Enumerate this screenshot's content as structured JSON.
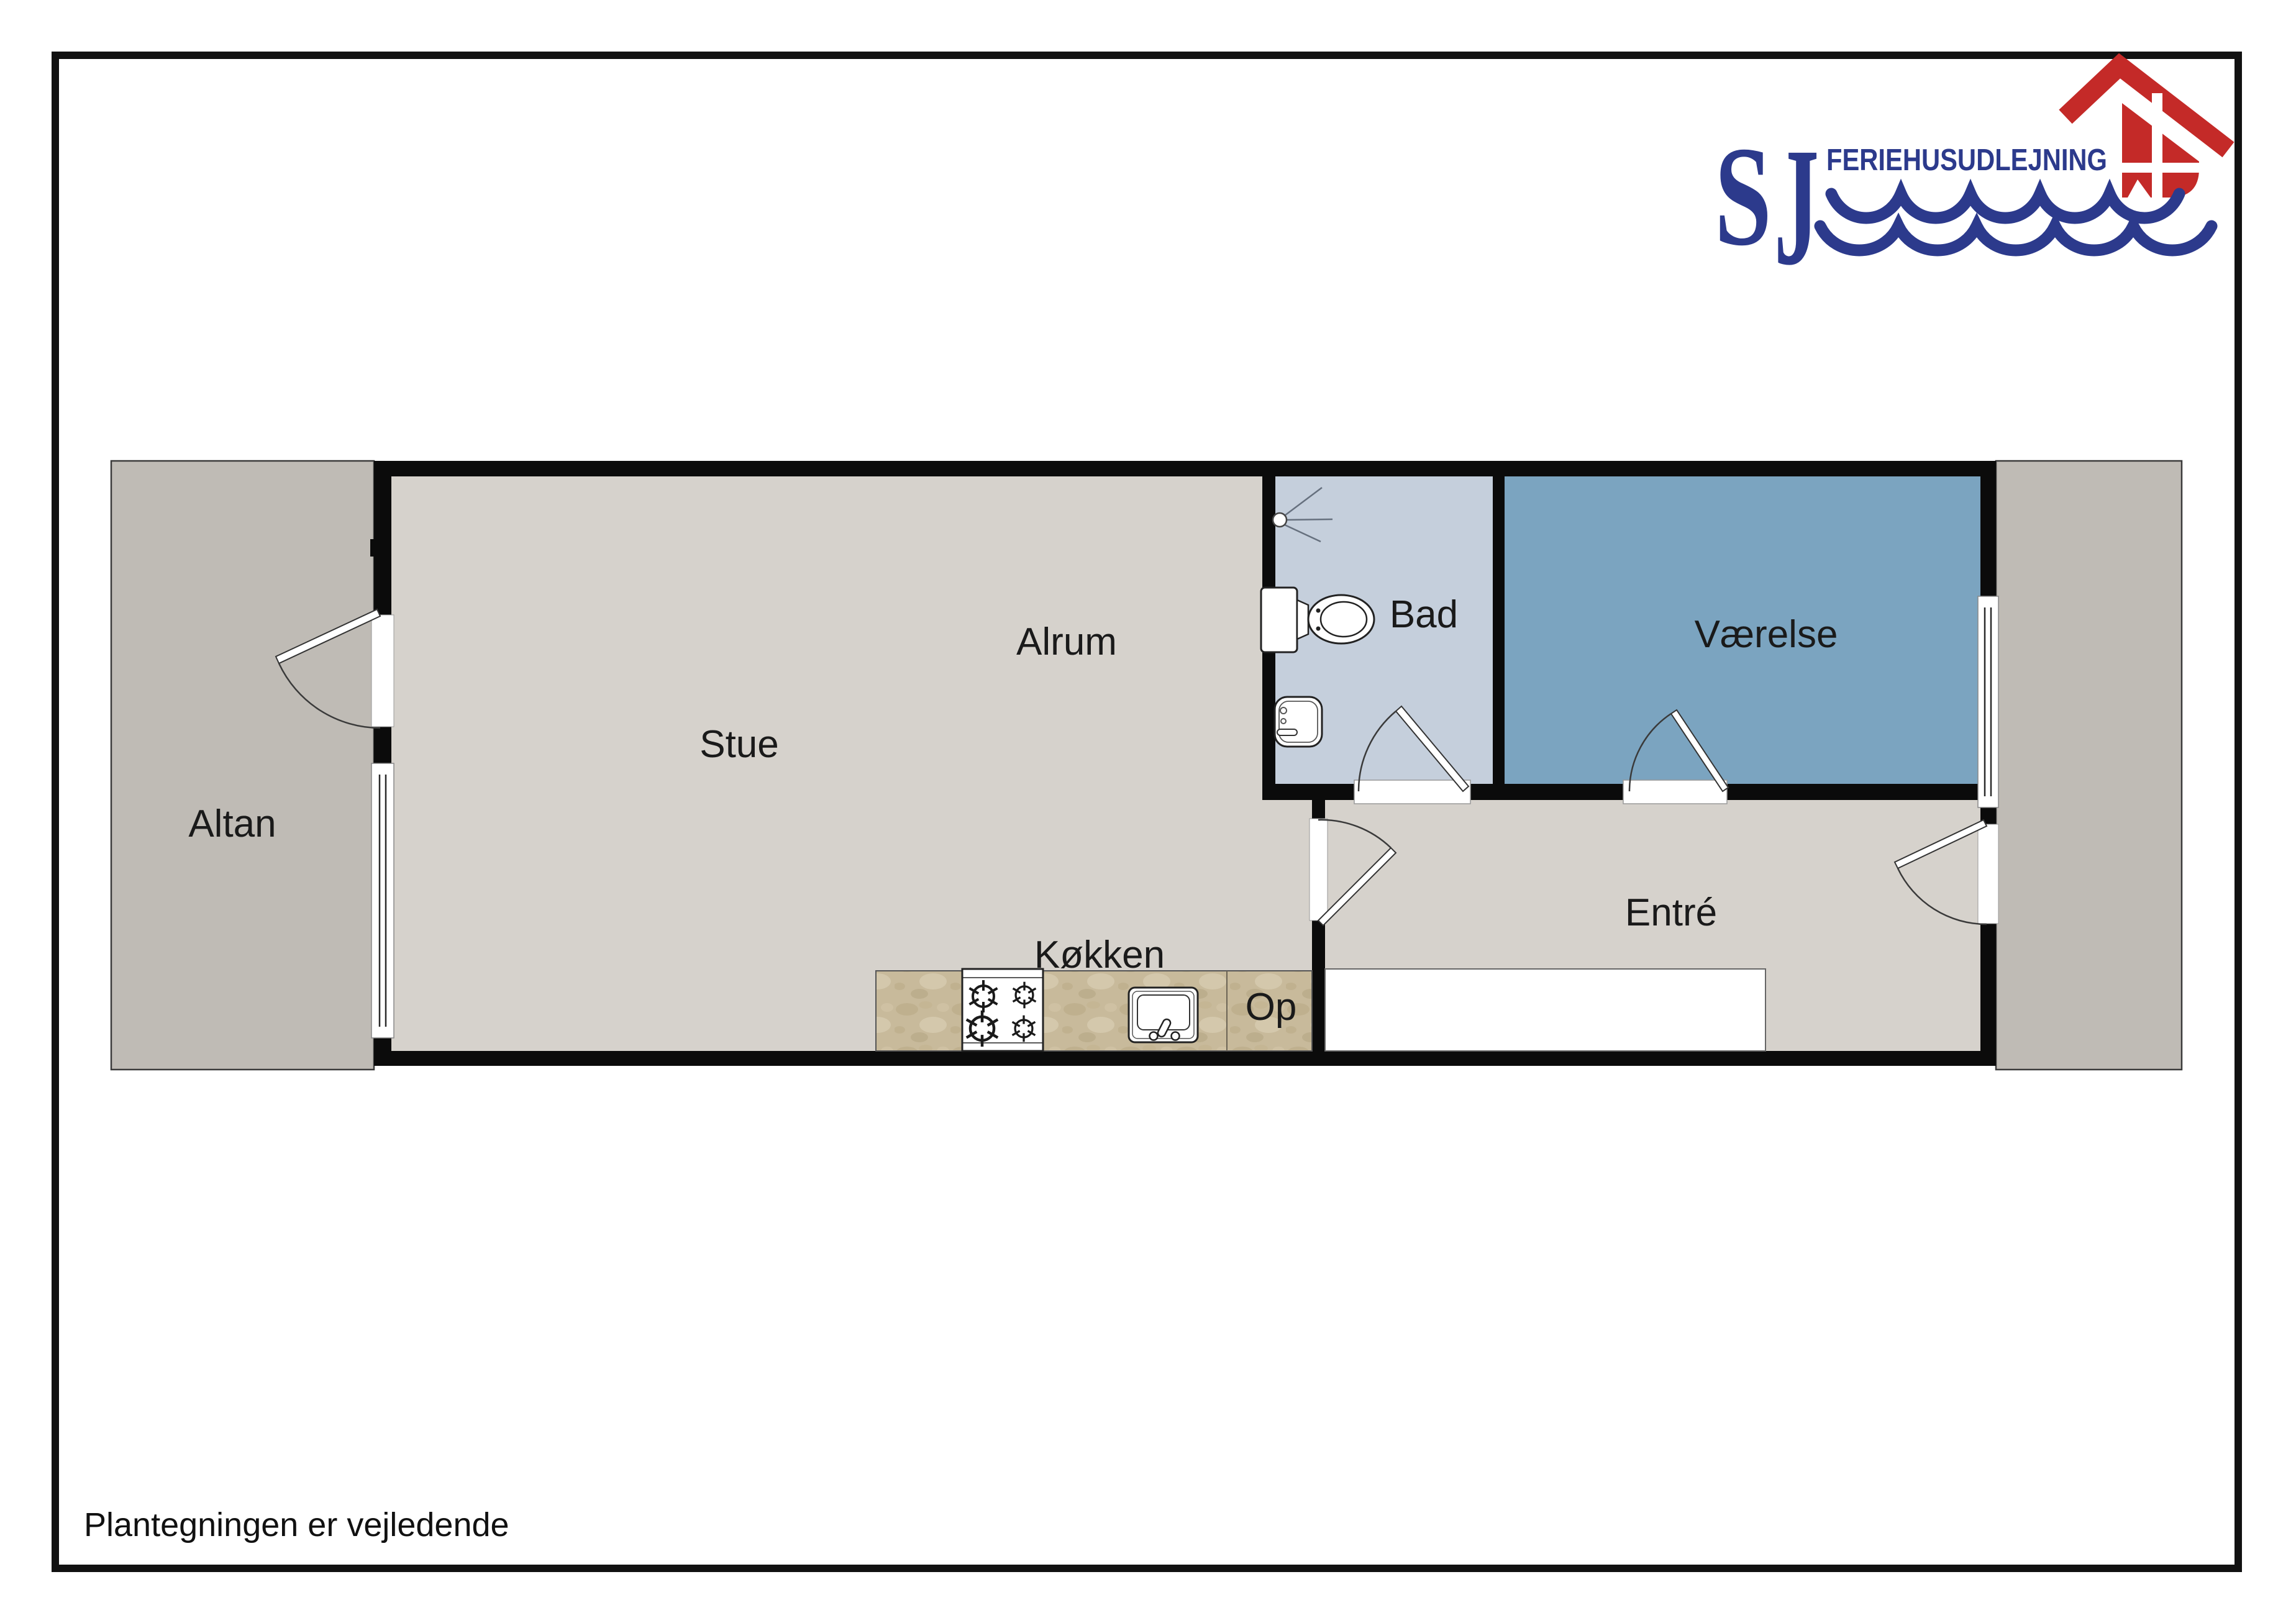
{
  "page": {
    "footnote": "Plantegningen er vejledende",
    "frame_color": "#111111",
    "background": "#ffffff"
  },
  "logo": {
    "monogram_s": "S",
    "monogram_j": "J",
    "wordmark": "FERIEHUSUDLEJNING",
    "colors": {
      "navy": "#2C3A8C",
      "red": "#C42A28"
    }
  },
  "floorplan": {
    "rooms": [
      {
        "id": "altan",
        "label": "Altan"
      },
      {
        "id": "stue",
        "label": "Stue"
      },
      {
        "id": "alrum",
        "label": "Alrum"
      },
      {
        "id": "koekken",
        "label": "Køkken"
      },
      {
        "id": "bad",
        "label": "Bad"
      },
      {
        "id": "vaerelse",
        "label": "Værelse"
      },
      {
        "id": "entre",
        "label": "Entré"
      },
      {
        "id": "stairs",
        "label": "Op"
      }
    ],
    "fixtures": [
      "shower-icon",
      "toilet-icon",
      "hand-basin-icon",
      "stove-icon",
      "kitchen-sink-icon",
      "stair-void"
    ],
    "colors": {
      "wall": "#0b0b0b",
      "floor": "#D6D2CC",
      "terrace": "#BFBBB5",
      "bathroom": "#C5CFDC",
      "bedroom": "#7BA4C0",
      "counter": "#C8BA9B"
    }
  }
}
